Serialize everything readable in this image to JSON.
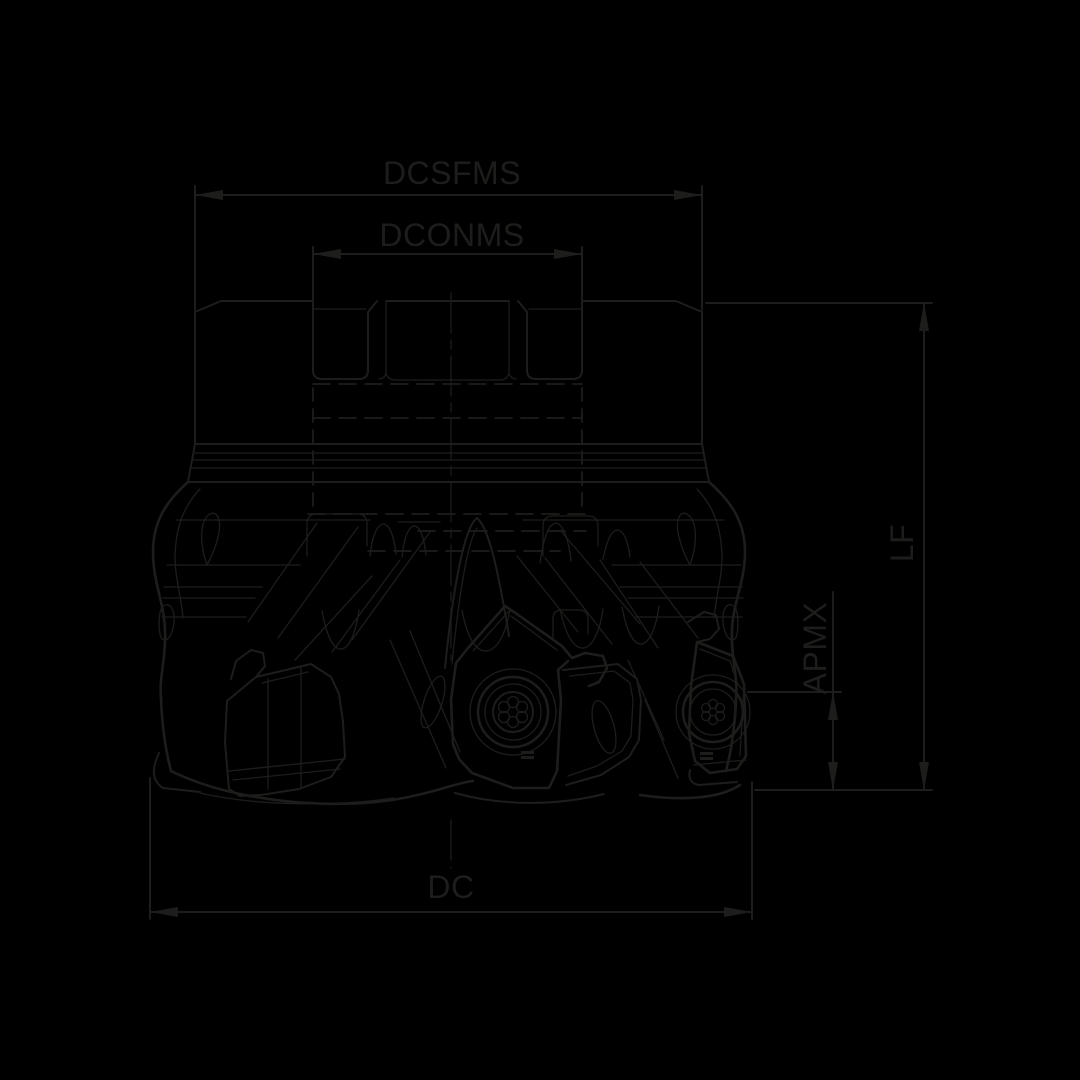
{
  "page": {
    "background_color": "#000000",
    "line_color": "#1d1d1b"
  },
  "drawing": {
    "title": "Face milling cutter with indexable inserts — side view technical drawing",
    "labels": {
      "dcsfms": "DCSFMS",
      "dconms": "DCONMS",
      "lf": "LF",
      "apmx": "APMX",
      "dc": "DC"
    }
  }
}
